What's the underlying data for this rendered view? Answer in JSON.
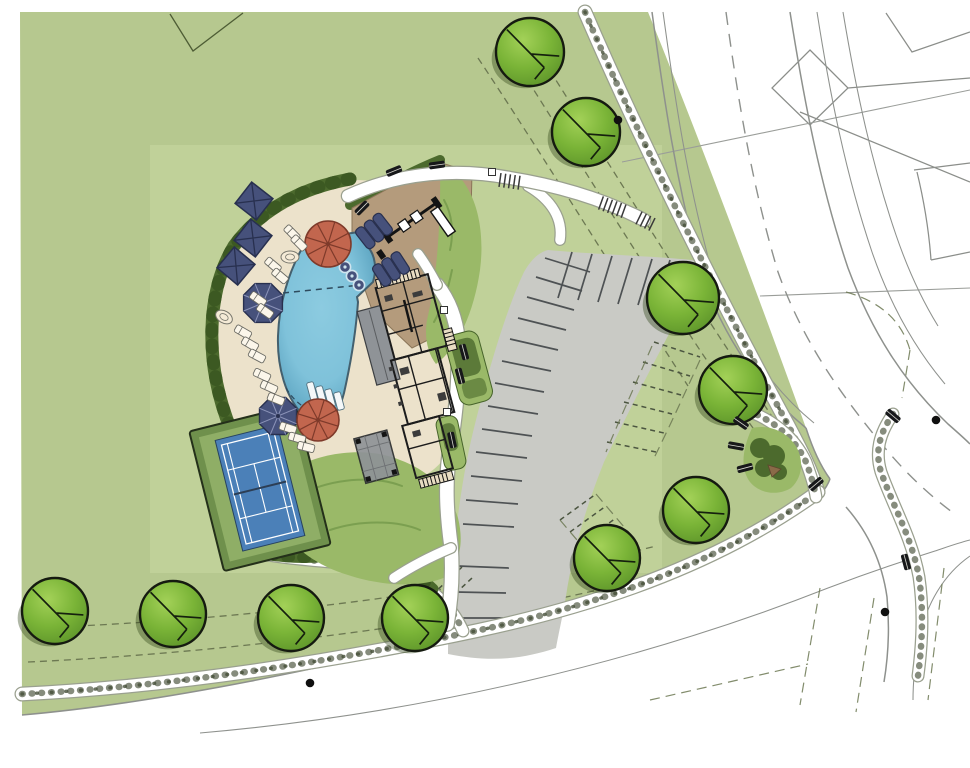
{
  "meta": {
    "title": "Amenity center site plan rendering",
    "document_type": "architectural-site-plan",
    "visible_text": []
  },
  "palette": {
    "paper": "#ffffff",
    "grass": "#b6c88f",
    "grass_light": "#c9d9a2",
    "grass_mid": "#9ab968",
    "hedge": "#4c6a2d",
    "hedge_dark": "#3a5621",
    "deck": "#ece2cb",
    "sand": "#b49b7c",
    "pool_fill": "#7fc2da",
    "pool_deep": "#58a0bd",
    "pool_edge": "#44606e",
    "navy": "#46517b",
    "navy_dark": "#28304f",
    "red_umbrella": "#c2664e",
    "red_dark": "#7e3a2a",
    "parking": "#c9cac5",
    "stall": "#4e5254",
    "road_line": "#8e918d",
    "walk_edge": "#9aa08f",
    "tan_building": "#dcab6f",
    "roof_gray": "#8f9397",
    "wall": "#1c1c1c",
    "tennis_green": "#8fae66",
    "tennis_border": "#6f904c",
    "court_blue": "#4b80b8",
    "tree_fill": "#7ab437",
    "tree_hi": "#a3d158",
    "stipple": "#454f38",
    "dash_line": "#6c7852"
  },
  "features": [
    {
      "id": "swimming-pool",
      "label": "free-form swimming pool"
    },
    {
      "id": "clubhouse",
      "label": "clubhouse building"
    },
    {
      "id": "tennis-court",
      "label": "tennis court"
    },
    {
      "id": "playground",
      "label": "playground sand area"
    },
    {
      "id": "parking-lot",
      "label": "curved parking lot with future dashed stalls"
    },
    {
      "id": "pool-deck",
      "label": "pool deck with umbrellas and loungers"
    },
    {
      "id": "roads",
      "label": "perimeter streets with sidewalks"
    },
    {
      "id": "trees",
      "label": "street trees"
    }
  ],
  "site": {
    "trees": [
      [
        530,
        52,
        34
      ],
      [
        586,
        132,
        34
      ],
      [
        683,
        298,
        36
      ],
      [
        733,
        390,
        34
      ],
      [
        696,
        510,
        33
      ],
      [
        607,
        558,
        33
      ],
      [
        415,
        618,
        33
      ],
      [
        291,
        618,
        33
      ],
      [
        173,
        614,
        33
      ],
      [
        55,
        611,
        33
      ]
    ],
    "square_umbrellas": [
      [
        254,
        201,
        38
      ],
      [
        253,
        238,
        38
      ],
      [
        236,
        266,
        40
      ]
    ],
    "navy_round_umbrellas": [
      [
        263,
        303,
        21
      ],
      [
        278,
        416,
        20
      ]
    ],
    "red_umbrellas": [
      [
        328,
        244,
        23
      ],
      [
        318,
        420,
        21
      ]
    ],
    "cabana_loungers": [
      [
        374,
        231,
        -38
      ],
      [
        391,
        269,
        -33
      ]
    ],
    "loungers": [
      [
        273,
        265,
        -50
      ],
      [
        280,
        276,
        -50
      ],
      [
        258,
        299,
        -55
      ],
      [
        265,
        311,
        -55
      ],
      [
        243,
        332,
        -60
      ],
      [
        250,
        344,
        -60
      ],
      [
        257,
        356,
        -62
      ],
      [
        262,
        375,
        -65
      ],
      [
        269,
        387,
        -66
      ],
      [
        276,
        399,
        -68
      ],
      [
        288,
        428,
        -72
      ],
      [
        297,
        438,
        -74
      ],
      [
        306,
        447,
        -76
      ],
      [
        292,
        233,
        -45
      ],
      [
        299,
        243,
        -45
      ]
    ],
    "pool_loungers": [
      [
        312,
        391
      ],
      [
        321,
        395
      ],
      [
        330,
        398
      ],
      [
        339,
        401
      ]
    ],
    "spa_tables": [
      [
        345,
        267
      ],
      [
        352,
        276
      ],
      [
        359,
        285
      ]
    ],
    "tables": [
      [
        290,
        257,
        0
      ],
      [
        224,
        317,
        30
      ]
    ],
    "benches": [
      [
        394,
        171,
        -22
      ],
      [
        437,
        165,
        -8
      ],
      [
        362,
        208,
        -45
      ],
      [
        741,
        423,
        35
      ],
      [
        736,
        446,
        10
      ],
      [
        745,
        468,
        -15
      ],
      [
        893,
        416,
        40
      ],
      [
        906,
        562,
        75
      ],
      [
        816,
        484,
        -40
      ],
      [
        464,
        352,
        75
      ],
      [
        460,
        376,
        75
      ],
      [
        452,
        440,
        78
      ]
    ],
    "trash_cans": [
      [
        492,
        172
      ],
      [
        444,
        310
      ],
      [
        447,
        412
      ]
    ],
    "utility_dots": [
      [
        618,
        120
      ],
      [
        310,
        683
      ],
      [
        885,
        612
      ],
      [
        936,
        420
      ]
    ],
    "crosswalks": [
      {
        "x": 500,
        "y": 180,
        "rot": 8,
        "n": 5
      },
      {
        "x": 601,
        "y": 203,
        "rot": 20,
        "n": 6
      },
      {
        "x": 639,
        "y": 218,
        "rot": 26,
        "n": 4
      }
    ],
    "parking_stalls_solid": [
      [
        545,
        258,
        590,
        272
      ],
      [
        536,
        277,
        582,
        291
      ],
      [
        527,
        297,
        574,
        310
      ],
      [
        518,
        318,
        566,
        330
      ],
      [
        510,
        339,
        558,
        350
      ],
      [
        502,
        361,
        551,
        371
      ],
      [
        495,
        383,
        544,
        392
      ],
      [
        488,
        406,
        538,
        414
      ],
      [
        482,
        429,
        532,
        436
      ],
      [
        476,
        452,
        527,
        458
      ],
      [
        471,
        476,
        522,
        481
      ],
      [
        466,
        500,
        518,
        504
      ],
      [
        463,
        524,
        514,
        527
      ],
      [
        458,
        566,
        509,
        568
      ],
      [
        456,
        592,
        506,
        593
      ],
      [
        454,
        618,
        503,
        618
      ],
      [
        572,
        252,
        558,
        298
      ],
      [
        592,
        254,
        578,
        300
      ],
      [
        612,
        256,
        598,
        302
      ],
      [
        632,
        258,
        618,
        304
      ],
      [
        652,
        259,
        638,
        305
      ],
      [
        670,
        260,
        656,
        306
      ]
    ],
    "parking_stalls_dashed": [
      [
        654,
        342,
        700,
        357
      ],
      [
        643,
        362,
        690,
        376
      ],
      [
        633,
        382,
        681,
        395
      ],
      [
        624,
        402,
        672,
        414
      ],
      [
        615,
        422,
        664,
        433
      ],
      [
        607,
        442,
        656,
        452
      ],
      [
        402,
        560,
        432,
        532
      ],
      [
        412,
        572,
        442,
        544
      ],
      [
        422,
        584,
        452,
        556
      ],
      [
        432,
        595,
        462,
        567
      ],
      [
        442,
        606,
        472,
        578
      ],
      [
        560,
        520,
        596,
        494
      ],
      [
        570,
        532,
        606,
        506
      ],
      [
        580,
        544,
        616,
        518
      ],
      [
        590,
        556,
        626,
        530
      ],
      [
        600,
        567,
        636,
        541
      ]
    ]
  }
}
